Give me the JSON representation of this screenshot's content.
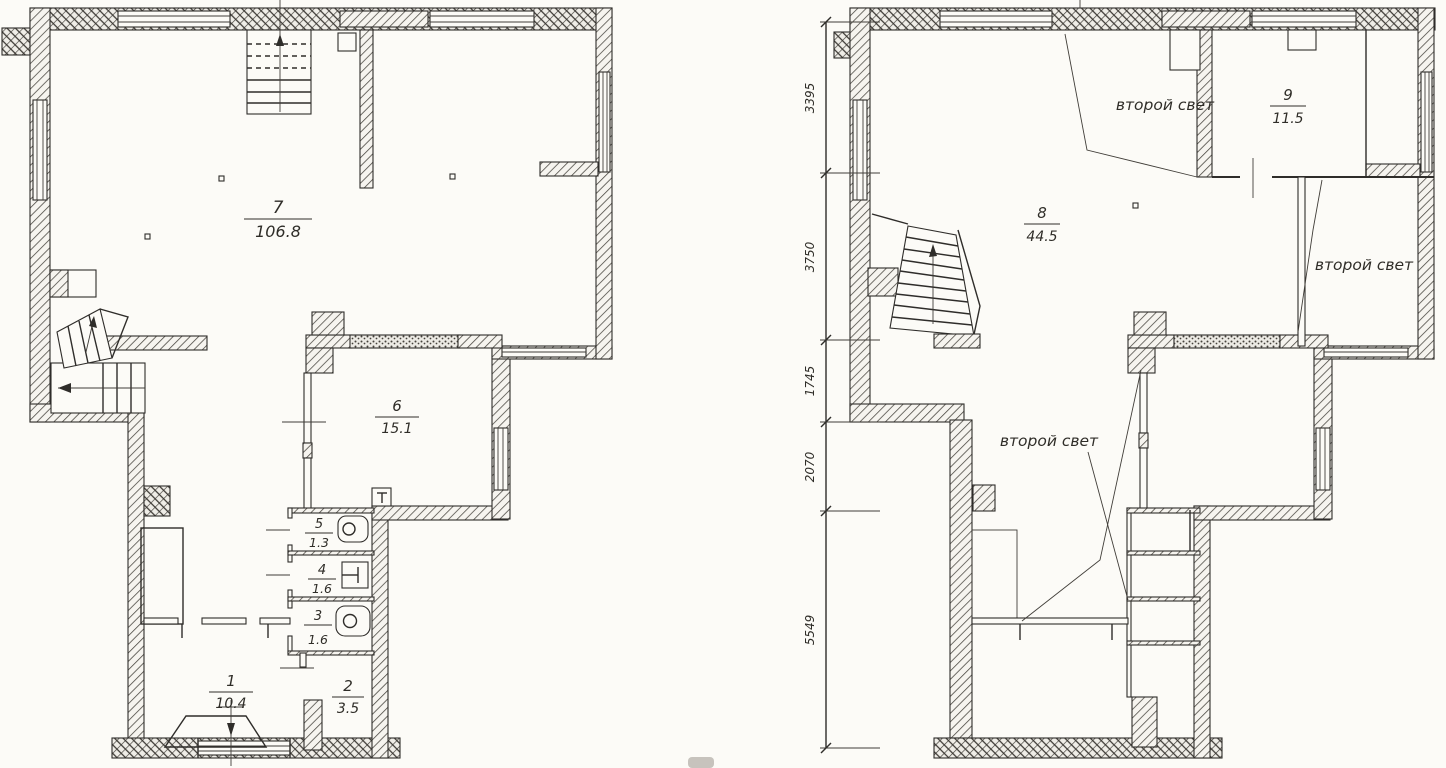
{
  "left_plan": {
    "rooms": [
      {
        "number": "7",
        "area": "106.8"
      },
      {
        "number": "6",
        "area": "15.1"
      },
      {
        "number": "5",
        "area": "1.3"
      },
      {
        "number": "4",
        "area": "1.6"
      },
      {
        "number": "3",
        "area": "1.6"
      },
      {
        "number": "1",
        "area": "10.4"
      },
      {
        "number": "2",
        "area": "3.5"
      }
    ]
  },
  "right_plan": {
    "rooms": [
      {
        "number": "8",
        "area": "44.5"
      },
      {
        "number": "9",
        "area": "11.5"
      }
    ],
    "annotations": [
      {
        "text": "второй свет"
      },
      {
        "text": "второй свет"
      },
      {
        "text": "второй свет"
      }
    ],
    "dimensions": [
      {
        "value": "3395"
      },
      {
        "value": "3750"
      },
      {
        "value": "1745"
      },
      {
        "value": "2070"
      },
      {
        "value": "5549"
      }
    ]
  },
  "colors": {
    "paper": "#fcfbf7",
    "ink": "#2f2d2a"
  }
}
